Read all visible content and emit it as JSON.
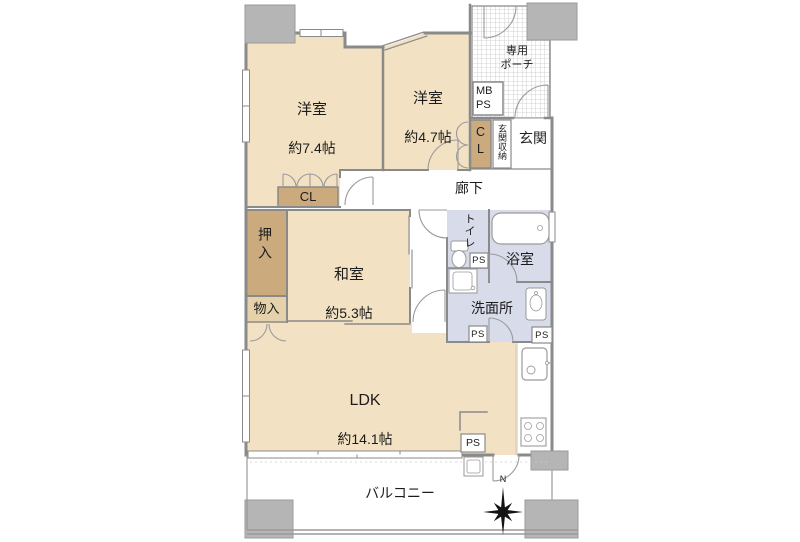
{
  "rooms": {
    "western1": {
      "label": "洋室",
      "area": "約7.4帖"
    },
    "western2": {
      "label": "洋室",
      "area": "約4.7帖"
    },
    "japanese": {
      "label": "和室",
      "area": "約5.3帖"
    },
    "ldk": {
      "label": "LDK",
      "area": "約14.1帖"
    },
    "porch": {
      "label": "専用\nポーチ"
    },
    "entrance": {
      "label": "玄関"
    },
    "entrance_storage": {
      "label": "玄関収納"
    },
    "hallway": {
      "label": "廊下"
    },
    "toilet": {
      "label": "トイレ"
    },
    "bathroom": {
      "label": "浴室"
    },
    "washroom": {
      "label": "洗面所"
    },
    "balcony": {
      "label": "バルコニー"
    }
  },
  "storage": {
    "closet_main": "CL",
    "closet_entrance": "CL",
    "oshiire": "押入",
    "monoire": "物入"
  },
  "utility": {
    "mb": "MB",
    "ps": "PS"
  },
  "compass": {
    "north": "N"
  },
  "colors": {
    "room_tan": "#f2e2c3",
    "closet_brown": "#cbaa7e",
    "storage_tan": "#e6d2aa",
    "wet_blue": "#d8dbea",
    "column_gray": "#b5b5b5",
    "wall_gray": "#8a8a8a"
  }
}
